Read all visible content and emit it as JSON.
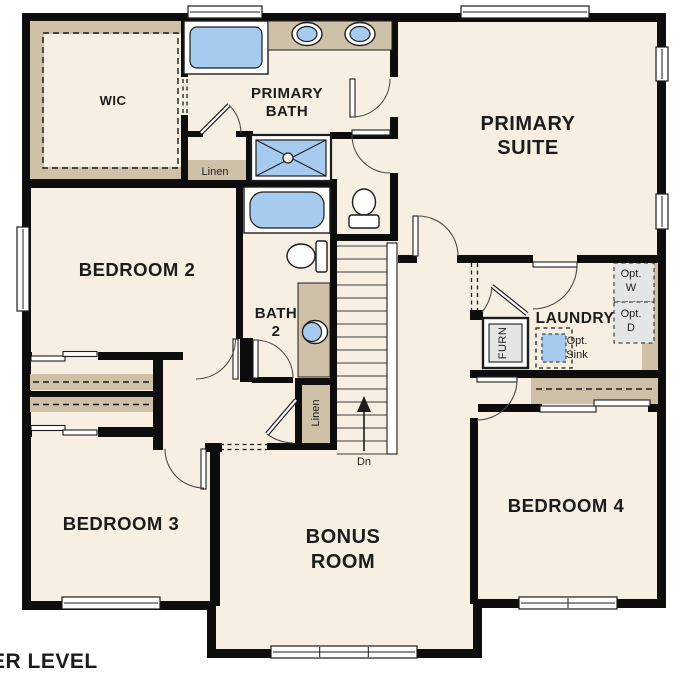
{
  "plan": {
    "floor_label": "UPPER LEVEL",
    "stairs": {
      "direction_label": "Dn"
    },
    "rooms": {
      "wic": {
        "label": "WIC"
      },
      "primary_bath": {
        "line1": "PRIMARY",
        "line2": "BATH"
      },
      "primary_suite": {
        "line1": "PRIMARY",
        "line2": "SUITE"
      },
      "bedroom2": {
        "label": "BEDROOM 2"
      },
      "bath2": {
        "line1": "BATH",
        "line2": "2"
      },
      "laundry": {
        "label": "LAUNDRY"
      },
      "bedroom3": {
        "label": "BEDROOM 3"
      },
      "bonus_room": {
        "line1": "BONUS",
        "line2": "ROOM"
      },
      "bedroom4": {
        "label": "BEDROOM 4"
      }
    },
    "closets": {
      "linen_top": {
        "label": "Linen"
      },
      "linen_hall": {
        "label": "Linen"
      }
    },
    "equipment": {
      "furnace": {
        "label": "FURN"
      },
      "washer": {
        "line1": "Opt.",
        "line2": "W"
      },
      "dryer": {
        "line1": "Opt.",
        "line2": "D"
      },
      "sink": {
        "line1": "Opt.",
        "line2": "Sink"
      }
    },
    "colors": {
      "background": "#ffffff",
      "floor": "#f6efe2",
      "wall": "#0d0d0d",
      "shelf": "#cfc1a8",
      "fixture_blue": "#a7cbee",
      "appliance_gray": "#e3e6e5"
    }
  }
}
